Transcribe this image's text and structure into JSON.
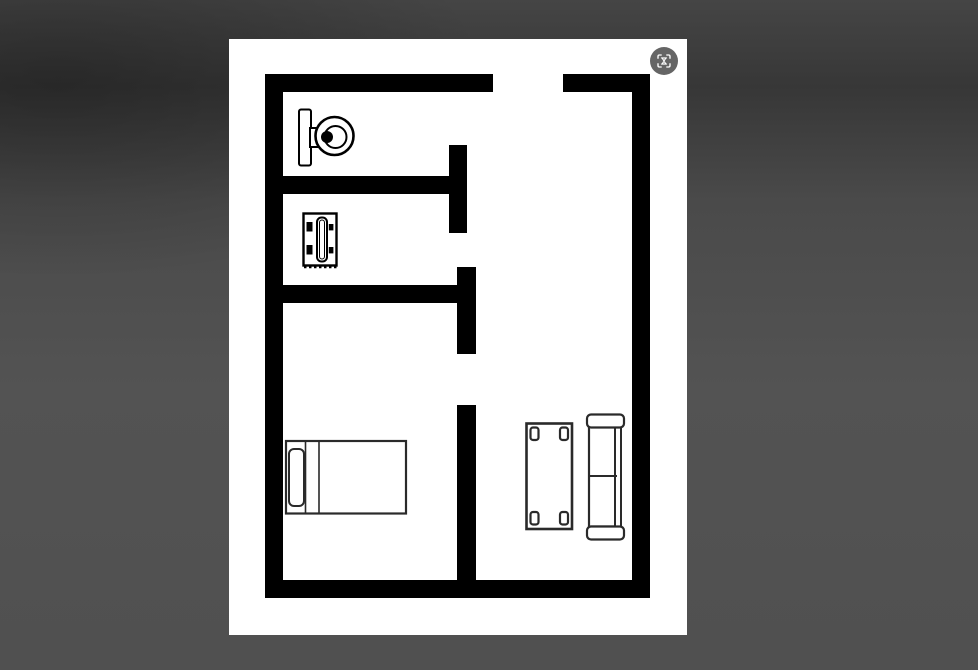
{
  "viewer": {
    "kind": "image-preview",
    "backdrop_color": "#4f4f4f",
    "backdrop_dark_band": "#373737"
  },
  "image": {
    "type": "floor-plan-drawing",
    "canvas_color": "#ffffff",
    "line_color": "#000000",
    "rooms_count": 4,
    "furniture_icons": [
      {
        "icon": "toilet-icon",
        "location": "top-left-room"
      },
      {
        "icon": "small-table-icon",
        "location": "middle-left-room"
      },
      {
        "icon": "bed-icon",
        "location": "bottom-left-room"
      },
      {
        "icon": "coffee-table-icon",
        "location": "right-room"
      },
      {
        "icon": "sofa-icon",
        "location": "right-room"
      }
    ]
  },
  "controls": {
    "visual_search": {
      "icon": "visual-search-icon",
      "background": "#3e3e3e",
      "glyph_color": "#ffffff"
    }
  },
  "colors": {
    "walls": "#000000",
    "furniture_fill": "#ffffff",
    "canvas": "#ffffff",
    "backdrop": "#4f4f4f"
  }
}
